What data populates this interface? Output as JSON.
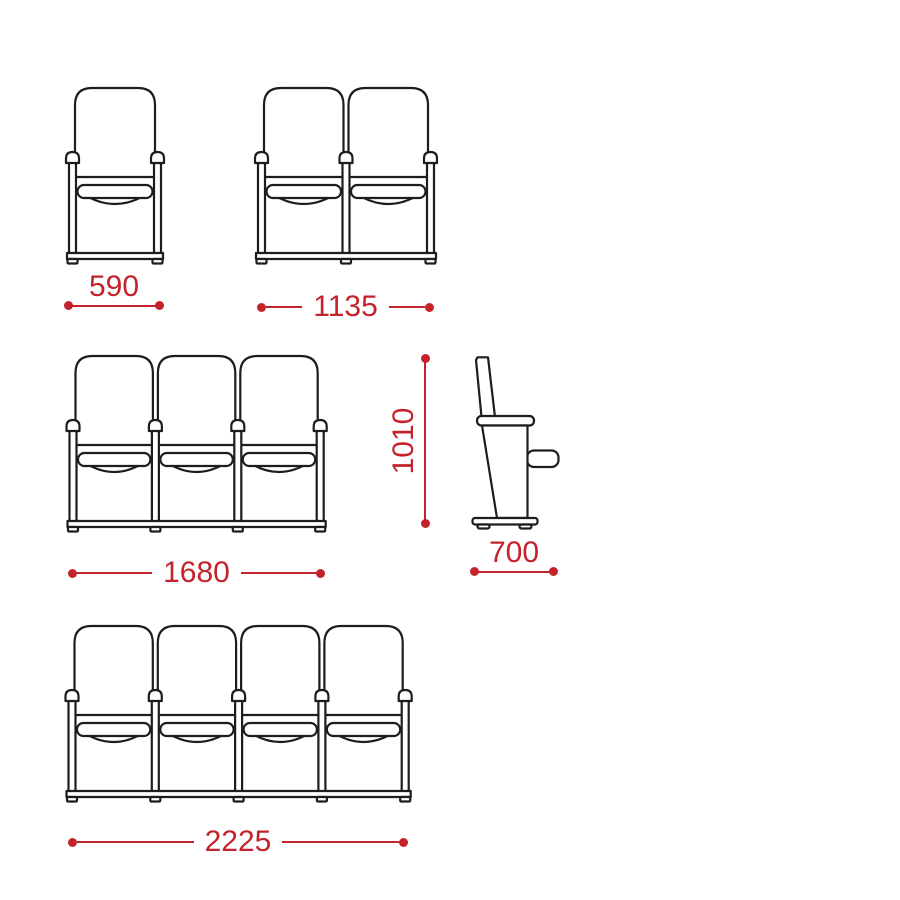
{
  "canvas": {
    "background": "#ffffff",
    "line_color": "#1d1d1d",
    "dimension_color": "#c4232b"
  },
  "views": {
    "single_front": "front view, 1 seat",
    "double_front": "front view, 2 seats",
    "triple_front": "front view, 3 seats",
    "side": "side view, folded seat",
    "quad_front": "front view, 4 seats"
  },
  "dimensions": {
    "single_width": "590",
    "double_width": "1135",
    "triple_width": "1680",
    "row_height": "1010",
    "seat_depth": "700",
    "quad_width": "2225"
  }
}
